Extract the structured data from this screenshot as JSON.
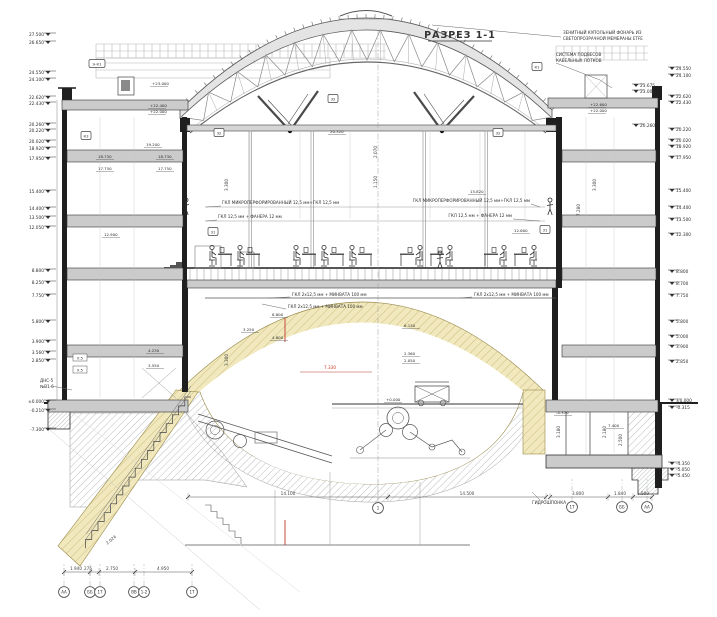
{
  "title": {
    "text": "РАЗРЕЗ 1-1"
  },
  "notes": [
    {
      "id": "skylight",
      "lines": [
        "ЗЕНИТНЫЙ КУПОЛЬНЫЙ ФОНАРЬ ИЗ",
        "СВЕТОПРОЗРАЧНОЙ МЕМБРАНЫ ETFE"
      ],
      "x": 563,
      "y": 34,
      "anchor": "start",
      "leader": [
        [
          561,
          37
        ],
        [
          432,
          25
        ]
      ]
    },
    {
      "id": "cable-trays",
      "lines": [
        "СИСТЕМА ПОДВЕСОВ",
        "КАБЕЛЬНЫХ ЛОТКОВ"
      ],
      "x": 556,
      "y": 56,
      "anchor": "start",
      "leader": [
        [
          556,
          63
        ],
        [
          600,
          80
        ],
        [
          612,
          88
        ]
      ]
    },
    {
      "id": "gkl-left-1",
      "lines": [
        "ГКЛ МИКРОПЕРФОРИРОВАННЫЙ 12,5 мм+ГКЛ 12,5 мм"
      ],
      "x": 222,
      "y": 204,
      "anchor": "start",
      "leader": [
        [
          221,
          206
        ],
        [
          206,
          207
        ]
      ]
    },
    {
      "id": "gkl-left-2",
      "lines": [
        "ГКЛ 12,5 мм + ФАНЕРА 12 мм"
      ],
      "x": 218,
      "y": 218,
      "anchor": "start",
      "leader": [
        [
          217,
          220
        ],
        [
          206,
          221
        ]
      ]
    },
    {
      "id": "gkl-right-1",
      "lines": [
        "ГКЛ МИКРОПЕРФОРИРОВАННЫЙ 12,5 мм+ГКЛ 12,5 мм"
      ],
      "x": 530,
      "y": 202,
      "anchor": "end",
      "leader": [
        [
          531,
          204
        ],
        [
          540,
          207
        ]
      ]
    },
    {
      "id": "gkl-right-2",
      "lines": [
        "ГКЛ 12,5 мм + ФАНЕРА 12 мм"
      ],
      "x": 512,
      "y": 217,
      "anchor": "end",
      "leader": [
        [
          513,
          219
        ],
        [
          540,
          221
        ]
      ]
    },
    {
      "id": "ceiling-left-1",
      "lines": [
        "ГКЛ 2x12,5 мм + МИНВАТА 100 мм"
      ],
      "x": 292,
      "y": 296,
      "anchor": "start",
      "leader": [
        [
          290,
          297
        ],
        [
          268,
          298
        ]
      ]
    },
    {
      "id": "ceiling-left-2",
      "lines": [
        "ГКЛ 2x12,5 мм + МИНВАТА 100 мм"
      ],
      "x": 288,
      "y": 308,
      "anchor": "start",
      "leader": [
        [
          286,
          309
        ],
        [
          262,
          304
        ]
      ]
    },
    {
      "id": "ceiling-right",
      "lines": [
        "ГКЛ 2x12,5 мм + МИНВАТА 100 мм"
      ],
      "x": 474,
      "y": 296,
      "anchor": "start",
      "leader": [
        [
          472,
          297
        ],
        [
          460,
          298
        ]
      ]
    },
    {
      "id": "dns",
      "lines": [
        "ДНС-5",
        "№В1-6"
      ],
      "x": 40,
      "y": 382,
      "anchor": "start",
      "leader": [
        [
          52,
          386
        ],
        [
          72,
          390
        ]
      ]
    },
    {
      "id": "gidroshponka",
      "lines": [
        "ГИДРОШПОНКА"
      ],
      "x": 566,
      "y": 504,
      "anchor": "end",
      "leader": [
        [
          540,
          500
        ],
        [
          532,
          492
        ]
      ]
    }
  ],
  "levels_left": [
    [
      "27.500",
      36
    ],
    [
      "26.650",
      44
    ],
    [
      "24.550",
      74
    ],
    [
      "24.100",
      81
    ],
    [
      "22.620",
      99
    ],
    [
      "22.430",
      105
    ],
    [
      "20.260",
      126
    ],
    [
      "20.220",
      132
    ],
    [
      "20.020",
      143
    ],
    [
      "18.920",
      150
    ],
    [
      "17.950",
      160
    ],
    [
      "15.400",
      193
    ],
    [
      "14.400",
      210
    ],
    [
      "13.500",
      219
    ],
    [
      "12.050",
      229
    ],
    [
      "8.800",
      272
    ],
    [
      "8.250",
      284
    ],
    [
      "7.750",
      297
    ],
    [
      "5.800",
      323
    ],
    [
      "3.900",
      343
    ],
    [
      "3.560",
      354
    ],
    [
      "2.850",
      362
    ],
    [
      "±0.000",
      403
    ],
    [
      "-0.210",
      412
    ],
    [
      "-7.300",
      431
    ]
  ],
  "levels_right": [
    [
      "24.550",
      70,
      0
    ],
    [
      "24.100",
      77,
      0
    ],
    [
      "23.675",
      87,
      1
    ],
    [
      "23.000",
      93,
      1
    ],
    [
      "22.620",
      98,
      0
    ],
    [
      "22.430",
      104,
      0
    ],
    [
      "20.260",
      127,
      1
    ],
    [
      "20.220",
      131,
      0
    ],
    [
      "20.020",
      142,
      0
    ],
    [
      "18.920",
      148,
      0
    ],
    [
      "17.950",
      159,
      0
    ],
    [
      "15.400",
      192,
      0
    ],
    [
      "14.400",
      209,
      0
    ],
    [
      "13.500",
      221,
      0
    ],
    [
      "12.300",
      236,
      0
    ],
    [
      "8.800",
      273,
      0
    ],
    [
      "8.700",
      285,
      0
    ],
    [
      "7.750",
      297,
      0
    ],
    [
      "5.800",
      323,
      0
    ],
    [
      "5.000",
      338,
      0
    ],
    [
      "3.900",
      348,
      0
    ],
    [
      "2.850",
      363,
      0
    ],
    [
      "±0.000",
      402,
      0
    ],
    [
      "-0.315",
      409,
      0
    ],
    [
      "-4.350",
      465,
      0
    ],
    [
      "-5.050",
      471,
      0
    ],
    [
      "-5.450",
      477,
      0
    ]
  ],
  "levels_interior": [
    [
      "+23.000",
      152,
      85
    ],
    [
      "+22.400",
      150,
      107
    ],
    [
      "+22.000",
      150,
      113
    ],
    [
      "+22.600",
      590,
      106
    ],
    [
      "+22.000",
      590,
      112
    ],
    [
      "20.320",
      330,
      133
    ],
    [
      "19.200",
      146,
      146
    ],
    [
      "18.730",
      98,
      158
    ],
    [
      "18.730",
      158,
      158
    ],
    [
      "17.750",
      98,
      170
    ],
    [
      "17.750",
      158,
      170
    ],
    [
      "12.900",
      104,
      236
    ],
    [
      "15.820",
      470,
      193
    ],
    [
      "12.600",
      514,
      232
    ],
    [
      "8.800",
      272,
      316
    ],
    [
      "6.130",
      404,
      327
    ],
    [
      "4.800",
      272,
      339
    ],
    [
      "3.250",
      243,
      331
    ],
    [
      "2.360",
      404,
      355
    ],
    [
      "2.050",
      404,
      362
    ],
    [
      "4.230",
      148,
      352
    ],
    [
      "3.550",
      148,
      367
    ],
    [
      "+0.000",
      386,
      401
    ],
    [
      "-4.370",
      556,
      414
    ],
    [
      "7.400",
      608,
      427
    ]
  ],
  "detail_boxes": [
    [
      "32",
      333,
      99
    ],
    [
      "32",
      219,
      133
    ],
    [
      "32",
      498,
      133
    ],
    [
      "К3",
      86,
      136
    ],
    [
      "Э-К1",
      97,
      64
    ],
    [
      "К1",
      537,
      67
    ],
    [
      "31",
      213,
      232
    ],
    [
      "31",
      545,
      230
    ]
  ],
  "grid_bubbles": [
    [
      "АА",
      64,
      592
    ],
    [
      "ББ",
      90,
      592
    ],
    [
      "1Т",
      100,
      592
    ],
    [
      "ВВ",
      134,
      592
    ],
    [
      "1-2",
      144,
      592
    ],
    [
      "1Т",
      192,
      592
    ],
    [
      "1",
      378,
      508
    ],
    [
      "1Т",
      572,
      507
    ],
    [
      "ББ",
      622,
      507
    ],
    [
      "АА",
      647,
      507
    ]
  ],
  "dim_chains": [
    {
      "y": 572,
      "x1": 64,
      "x2": 192,
      "ticks": [
        64,
        90,
        99,
        135,
        192
      ],
      "labels": [
        [
          "1.940",
          76
        ],
        [
          "275",
          88
        ],
        [
          "2.750",
          112
        ],
        [
          "4.950",
          163
        ]
      ]
    },
    {
      "y": 497,
      "x1": 188,
      "x2": 546,
      "ticks": [
        188,
        388,
        546
      ],
      "labels": [
        [
          "14.100",
          288
        ],
        [
          "14.500",
          467
        ]
      ]
    },
    {
      "y": 497,
      "x1": 550,
      "x2": 652,
      "ticks": [
        550,
        608,
        633,
        652
      ],
      "labels": [
        [
          "3.800",
          578
        ],
        [
          "1.840",
          620
        ],
        [
          "1.500",
          643
        ]
      ]
    }
  ],
  "dims_rotated": [
    [
      "2.024",
      112,
      541,
      -40
    ],
    [
      "3.300",
      228,
      185,
      -90
    ],
    [
      "3.300",
      228,
      360,
      -90
    ],
    [
      "3.300",
      596,
      185,
      -90
    ],
    [
      "2.070",
      377,
      152,
      -90
    ],
    [
      "1.150",
      377,
      182,
      -90
    ],
    [
      "7.280",
      580,
      210,
      -90
    ],
    [
      "3.180",
      560,
      432,
      -90
    ],
    [
      "2.180",
      606,
      432,
      -90
    ],
    [
      "2.500",
      622,
      440,
      -90
    ]
  ],
  "red_marks": {
    "dim_text": "7.330",
    "x": 330,
    "y": 369
  },
  "small_tags": [
    [
      "У.5",
      80,
      358
    ],
    [
      "У.5",
      80,
      370
    ]
  ],
  "colors": {
    "shell_yellow": "#f1e9bd",
    "shell_hatch_line": "#c0b070",
    "ground_hatch_line": "#9a9fa4",
    "wall_poche": "#1f1f1f",
    "slab_gray": "#cbcbcb",
    "line_dark": "#3a3a3a",
    "red_accent": "#c0392b"
  },
  "people": {
    "seated_x": [
      212,
      240,
      296,
      324,
      352,
      420,
      450,
      504,
      534
    ],
    "standing": [
      [
        186,
        215
      ],
      [
        550,
        215
      ],
      [
        440,
        268
      ]
    ]
  }
}
